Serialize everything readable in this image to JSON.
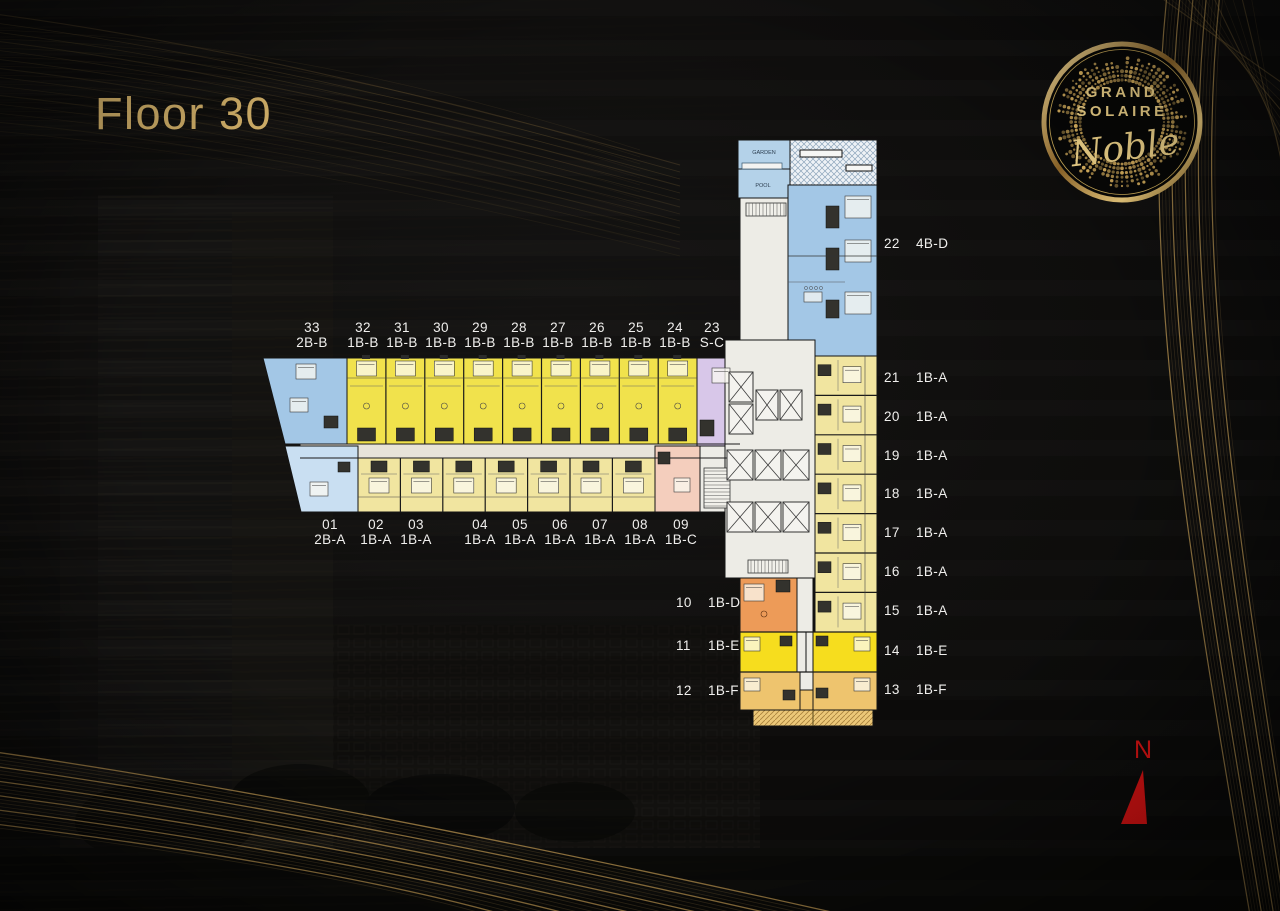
{
  "page": {
    "title": "Floor 30"
  },
  "logo": {
    "line1": "GRAND",
    "line2": "SOLAIRE",
    "script": "Noble"
  },
  "compass": {
    "label": "N"
  },
  "plan": {
    "garden_label": "GARDEN",
    "pool_label": "POOL",
    "top_units": [
      {
        "no": "33",
        "type": "2B-B"
      },
      {
        "no": "32",
        "type": "1B-B"
      },
      {
        "no": "31",
        "type": "1B-B"
      },
      {
        "no": "30",
        "type": "1B-B"
      },
      {
        "no": "29",
        "type": "1B-B"
      },
      {
        "no": "28",
        "type": "1B-B"
      },
      {
        "no": "27",
        "type": "1B-B"
      },
      {
        "no": "26",
        "type": "1B-B"
      },
      {
        "no": "25",
        "type": "1B-B"
      },
      {
        "no": "24",
        "type": "1B-B"
      },
      {
        "no": "23",
        "type": "S-C"
      }
    ],
    "bottom_units": [
      {
        "no": "01",
        "type": "2B-A"
      },
      {
        "no": "02",
        "type": "1B-A"
      },
      {
        "no": "03",
        "type": "1B-A"
      },
      {
        "no": "04",
        "type": "1B-A"
      },
      {
        "no": "05",
        "type": "1B-A"
      },
      {
        "no": "06",
        "type": "1B-A"
      },
      {
        "no": "07",
        "type": "1B-A"
      },
      {
        "no": "08",
        "type": "1B-A"
      },
      {
        "no": "09",
        "type": "1B-C"
      }
    ],
    "right_units": [
      {
        "no": "22",
        "type": "4B-D"
      },
      {
        "no": "21",
        "type": "1B-A"
      },
      {
        "no": "20",
        "type": "1B-A"
      },
      {
        "no": "19",
        "type": "1B-A"
      },
      {
        "no": "18",
        "type": "1B-A"
      },
      {
        "no": "17",
        "type": "1B-A"
      },
      {
        "no": "16",
        "type": "1B-A"
      },
      {
        "no": "15",
        "type": "1B-A"
      },
      {
        "no": "14",
        "type": "1B-E"
      },
      {
        "no": "13",
        "type": "1B-F"
      }
    ],
    "left_units": [
      {
        "no": "10",
        "type": "1B-D"
      },
      {
        "no": "11",
        "type": "1B-E"
      },
      {
        "no": "12",
        "type": "1B-F"
      }
    ]
  },
  "colors": {
    "gold": "#d2b069",
    "label_text": "#f0efed",
    "north": "#e01313",
    "unit_2b_b": "#a3c7e6",
    "unit_2b_a": "#c9dff2",
    "unit_1b_b": "#f1e24c",
    "unit_1b_a": "#f1e5a0",
    "unit_s_c": "#d8c7e9",
    "unit_1b_c": "#f4cebd",
    "unit_1b_d": "#ed9b58",
    "unit_1b_e": "#f6dd1e",
    "unit_1b_f": "#eec46e",
    "corridor": "#e7e3d9",
    "core_white": "#edece6",
    "garden": "#b4d2e9"
  }
}
